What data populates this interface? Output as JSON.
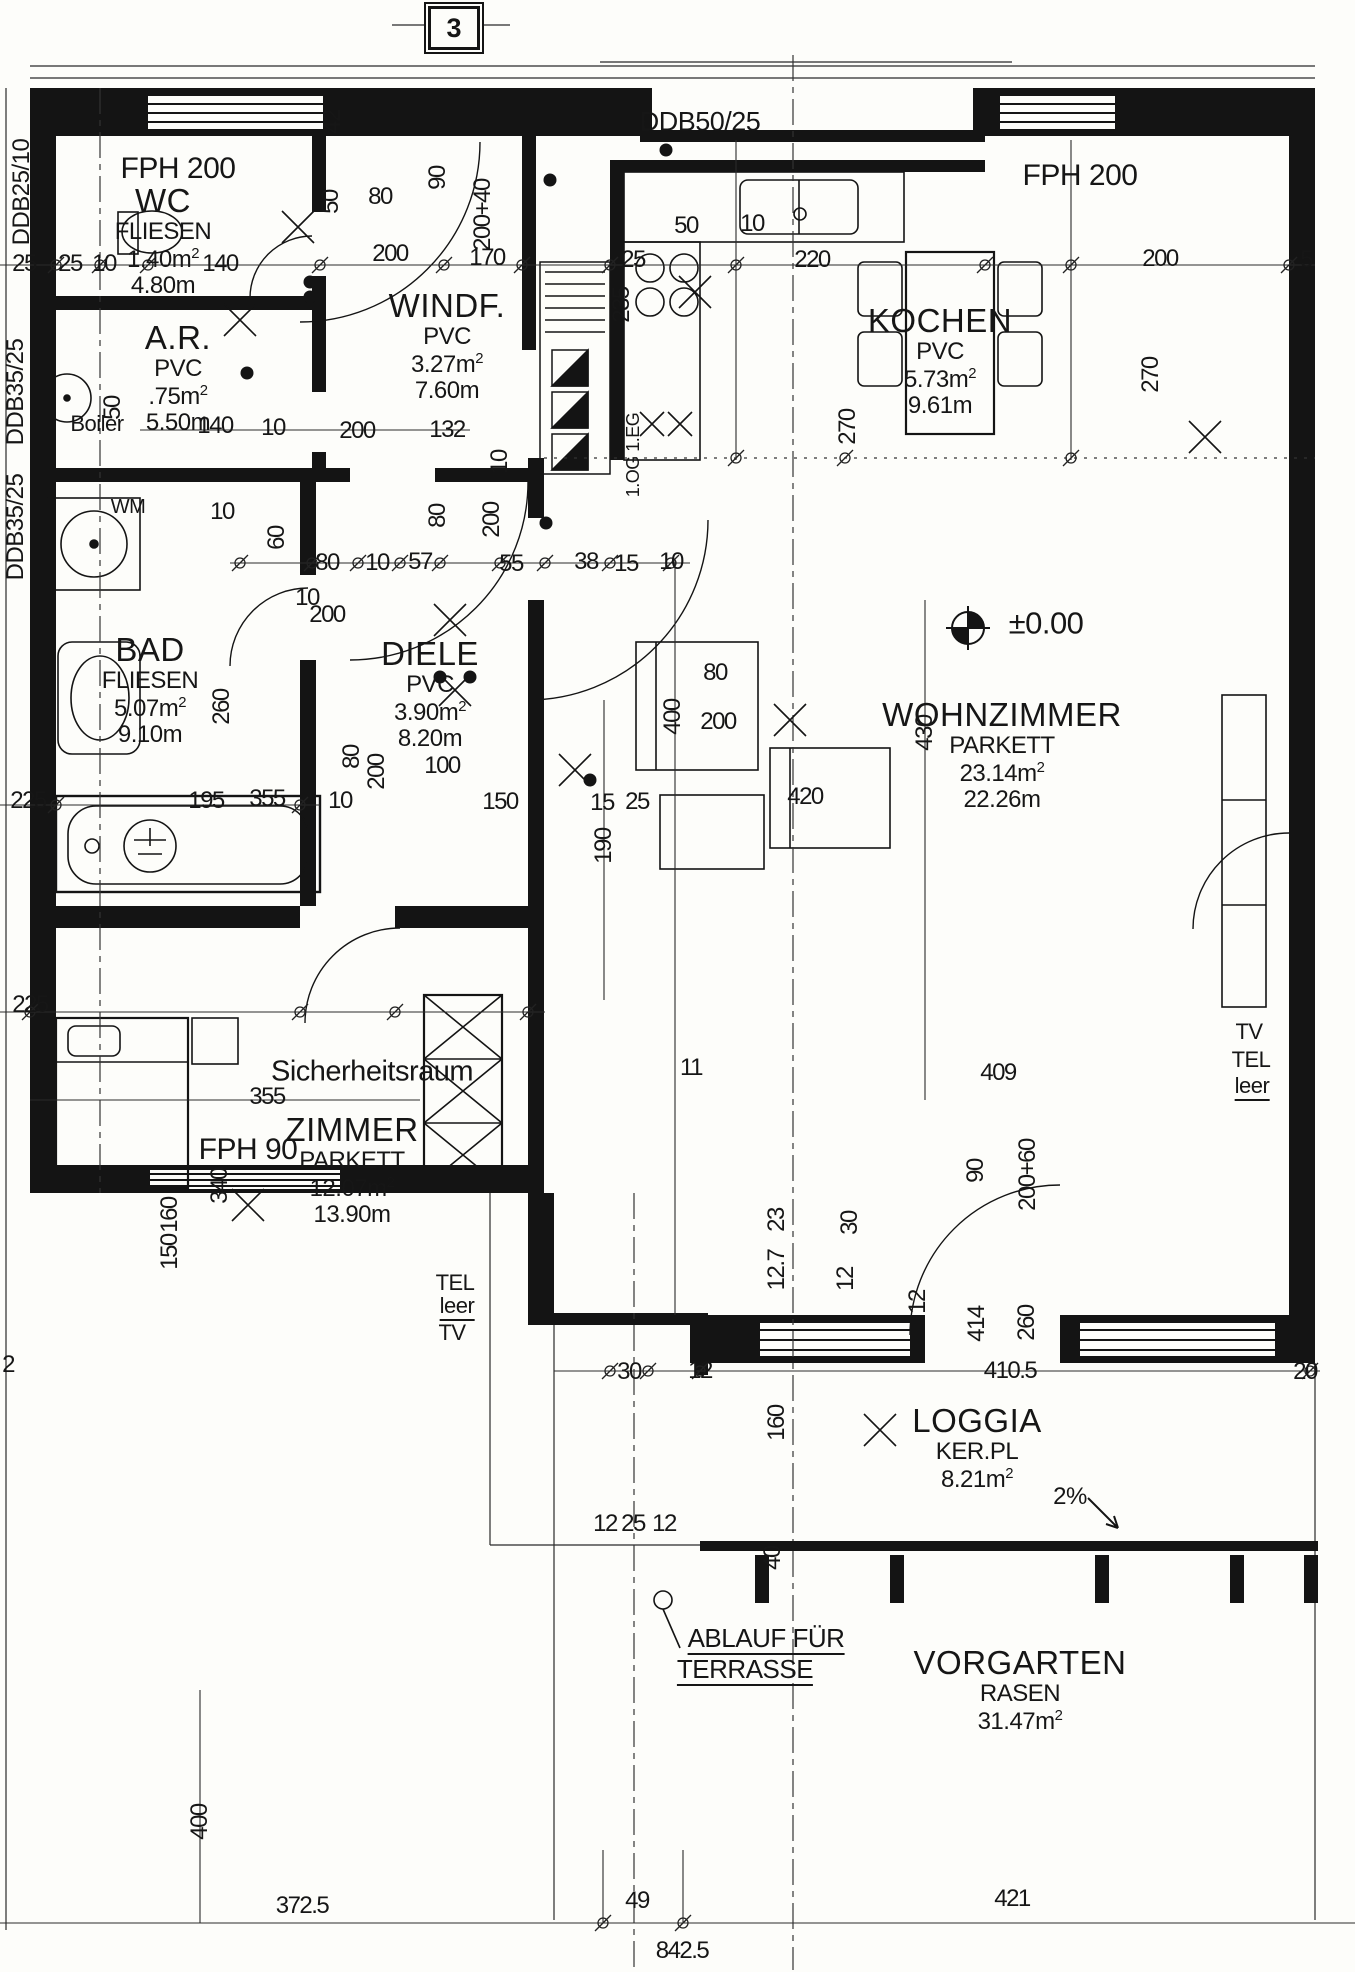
{
  "title": "Grundriss Wohnung EG (floor plan)",
  "sheet_number": "3",
  "colors": {
    "ink": "#161616",
    "paper": "#fdfdfa"
  },
  "rooms": [
    {
      "name": "WC",
      "floor": "FLIESEN",
      "area": "1.40",
      "perim": "4.80",
      "x": 163,
      "y": 183
    },
    {
      "name": "WINDF.",
      "floor": "PVC",
      "area": "3.27",
      "perim": "7.60",
      "x": 447,
      "y": 288
    },
    {
      "name": "A.R.",
      "floor": "PVC",
      "area": ".75",
      "perim": "5.50",
      "x": 178,
      "y": 320
    },
    {
      "name": "KOCHEN",
      "floor": "PVC",
      "area": "5.73",
      "perim": "9.61",
      "x": 940,
      "y": 303
    },
    {
      "name": "BAD",
      "floor": "FLIESEN",
      "area": "5.07",
      "perim": "9.10",
      "x": 150,
      "y": 632
    },
    {
      "name": "DIELE",
      "floor": "PVC",
      "area": "3.90",
      "perim": "8.20",
      "x": 430,
      "y": 636
    },
    {
      "name": "WOHNZIMMER",
      "floor": "PARKETT",
      "area": "23.14",
      "perim": "22.26",
      "x": 1002,
      "y": 697
    },
    {
      "name": "ZIMMER",
      "floor": "PARKETT",
      "area": "12.07",
      "perim": "13.90",
      "x": 352,
      "y": 1112
    },
    {
      "name": "LOGGIA",
      "floor": "KER.PL",
      "area": "8.21",
      "perim": "",
      "x": 977,
      "y": 1403
    },
    {
      "name": "VORGARTEN",
      "floor": "RASEN",
      "area": "31.47",
      "perim": "",
      "x": 1020,
      "y": 1645
    }
  ],
  "annotations": [
    {
      "id": "fph-200-left",
      "t": "FPH 200",
      "x": 178,
      "y": 169,
      "fs": 30
    },
    {
      "id": "ddb50-25",
      "t": "DDB50/25",
      "x": 700,
      "y": 122,
      "fs": 27
    },
    {
      "id": "fph-200-right",
      "t": "FPH 200",
      "x": 1080,
      "y": 176,
      "fs": 30
    },
    {
      "id": "fph-90",
      "t": "FPH 90",
      "x": 248,
      "y": 1150,
      "fs": 30
    },
    {
      "id": "ddb25-10",
      "t": "DDB25/10",
      "x": 22,
      "y": 192,
      "r": 1,
      "fs": 24
    },
    {
      "id": "ddb35-25-a",
      "t": "DDB35/25",
      "x": 16,
      "y": 392,
      "r": 1,
      "fs": 24
    },
    {
      "id": "ddb35-25-b",
      "t": "DDB35/25",
      "x": 16,
      "y": 527,
      "r": 1,
      "fs": 24
    },
    {
      "id": "wm",
      "t": "WM",
      "x": 128,
      "y": 507,
      "fs": 20
    },
    {
      "id": "boiler",
      "t": "Boiler",
      "x": 97,
      "y": 424,
      "fs": 22
    },
    {
      "id": "level",
      "t": "±0.00",
      "x": 1046,
      "y": 623,
      "fs": 31
    },
    {
      "id": "sicherheitsraum",
      "t": "Sicherheitsraum",
      "x": 372,
      "y": 1072,
      "fs": 29
    },
    {
      "id": "tv-right",
      "t": "TV",
      "x": 1249,
      "y": 1032,
      "fs": 22
    },
    {
      "id": "tel-right",
      "t": "TEL",
      "x": 1251,
      "y": 1060,
      "fs": 22
    },
    {
      "id": "leer-right",
      "t": "leer",
      "x": 1252,
      "y": 1088,
      "fs": 22,
      "u": 1
    },
    {
      "id": "tel-left",
      "t": "TEL",
      "x": 455,
      "y": 1283,
      "fs": 22
    },
    {
      "id": "leer-left",
      "t": "leer",
      "x": 457,
      "y": 1308,
      "fs": 22,
      "u": 1
    },
    {
      "id": "tv-left",
      "t": "TV",
      "x": 452,
      "y": 1333,
      "fs": 22
    },
    {
      "id": "ablauf",
      "t": "ABLAUF FÜR",
      "x": 766,
      "y": 1640,
      "fs": 26,
      "u": 1
    },
    {
      "id": "terrasse",
      "t": "TERRASSE",
      "x": 745,
      "y": 1671,
      "fs": 26,
      "u": 1
    },
    {
      "id": "slope",
      "t": "2%",
      "x": 1070,
      "y": 1497,
      "fs": 24
    },
    {
      "id": "og-eg",
      "t": "1.OG 1.EG",
      "x": 633,
      "y": 455,
      "r": 1,
      "fs": 18
    }
  ],
  "dimensions": [
    {
      "t": "25",
      "x": 24,
      "y": 264
    },
    {
      "t": "25",
      "x": 70,
      "y": 264
    },
    {
      "t": "10",
      "x": 104,
      "y": 264
    },
    {
      "t": "140",
      "x": 220,
      "y": 264
    },
    {
      "t": "200",
      "x": 390,
      "y": 254
    },
    {
      "t": "170",
      "x": 487,
      "y": 258
    },
    {
      "t": "25",
      "x": 633,
      "y": 260
    },
    {
      "t": "50",
      "x": 686,
      "y": 226
    },
    {
      "t": "10",
      "x": 752,
      "y": 224
    },
    {
      "t": "220",
      "x": 812,
      "y": 260
    },
    {
      "t": "200",
      "x": 1160,
      "y": 259
    },
    {
      "t": "5",
      "x": 1306,
      "y": 260
    },
    {
      "t": "42",
      "x": 333,
      "y": 122,
      "r": 1
    },
    {
      "t": "50",
      "x": 331,
      "y": 202,
      "r": 1
    },
    {
      "t": "80",
      "x": 380,
      "y": 197
    },
    {
      "t": "90",
      "x": 438,
      "y": 178,
      "r": 1
    },
    {
      "t": "200+40",
      "x": 483,
      "y": 215,
      "r": 1
    },
    {
      "t": "140",
      "x": 215,
      "y": 426
    },
    {
      "t": "10",
      "x": 273,
      "y": 428
    },
    {
      "t": "200",
      "x": 357,
      "y": 431
    },
    {
      "t": "132",
      "x": 447,
      "y": 430
    },
    {
      "t": "50",
      "x": 113,
      "y": 408,
      "r": 1
    },
    {
      "t": "235",
      "x": 622,
      "y": 305,
      "r": 1
    },
    {
      "t": "270",
      "x": 848,
      "y": 427,
      "r": 1
    },
    {
      "t": "270",
      "x": 1151,
      "y": 375,
      "r": 1
    },
    {
      "t": "10",
      "x": 500,
      "y": 462,
      "r": 1
    },
    {
      "t": "200",
      "x": 492,
      "y": 520,
      "r": 1
    },
    {
      "t": "80",
      "x": 438,
      "y": 516,
      "r": 1
    },
    {
      "t": "80",
      "x": 327,
      "y": 563
    },
    {
      "t": "10",
      "x": 377,
      "y": 563
    },
    {
      "t": "57",
      "x": 420,
      "y": 562
    },
    {
      "t": "55",
      "x": 511,
      "y": 564
    },
    {
      "t": "38",
      "x": 586,
      "y": 562
    },
    {
      "t": "15",
      "x": 626,
      "y": 564
    },
    {
      "t": "10",
      "x": 671,
      "y": 562
    },
    {
      "t": "200",
      "x": 327,
      "y": 615
    },
    {
      "t": "60",
      "x": 277,
      "y": 538,
      "r": 1
    },
    {
      "t": "10",
      "x": 222,
      "y": 512
    },
    {
      "t": "10",
      "x": 307,
      "y": 598
    },
    {
      "t": "260",
      "x": 222,
      "y": 707,
      "r": 1
    },
    {
      "t": "225",
      "x": 28,
      "y": 801
    },
    {
      "t": "195",
      "x": 206,
      "y": 801
    },
    {
      "t": "10",
      "x": 340,
      "y": 801
    },
    {
      "t": "150",
      "x": 500,
      "y": 802
    },
    {
      "t": "15",
      "x": 602,
      "y": 803
    },
    {
      "t": "25",
      "x": 637,
      "y": 802
    },
    {
      "t": "80",
      "x": 352,
      "y": 757,
      "r": 1
    },
    {
      "t": "200",
      "x": 377,
      "y": 772,
      "r": 1
    },
    {
      "t": "100",
      "x": 442,
      "y": 766
    },
    {
      "t": "80",
      "x": 715,
      "y": 673
    },
    {
      "t": "200",
      "x": 718,
      "y": 722
    },
    {
      "t": "400",
      "x": 673,
      "y": 717,
      "r": 1
    },
    {
      "t": "430",
      "x": 925,
      "y": 733,
      "r": 1
    },
    {
      "t": "420",
      "x": 805,
      "y": 797
    },
    {
      "t": "190",
      "x": 604,
      "y": 846,
      "r": 1
    },
    {
      "t": "409",
      "x": 998,
      "y": 1073
    },
    {
      "t": "11",
      "x": 691,
      "y": 1068
    },
    {
      "t": "90",
      "x": 976,
      "y": 1171,
      "r": 1
    },
    {
      "t": "200+60",
      "x": 1028,
      "y": 1175,
      "r": 1
    },
    {
      "t": "23",
      "x": 777,
      "y": 1220,
      "r": 1
    },
    {
      "t": "30",
      "x": 850,
      "y": 1223,
      "r": 1
    },
    {
      "t": "12.7",
      "x": 777,
      "y": 1270,
      "r": 1
    },
    {
      "t": "12",
      "x": 846,
      "y": 1279,
      "r": 1
    },
    {
      "t": "340",
      "x": 220,
      "y": 1186,
      "r": 1
    },
    {
      "t": "355",
      "x": 267,
      "y": 799
    },
    {
      "t": "355",
      "x": 267,
      "y": 1097
    },
    {
      "t": "225",
      "x": 30,
      "y": 1005
    },
    {
      "t": "2",
      "x": 8,
      "y": 1365
    },
    {
      "t": "160",
      "x": 170,
      "y": 1215,
      "r": 1
    },
    {
      "t": "150",
      "x": 170,
      "y": 1252,
      "r": 1
    },
    {
      "t": "30",
      "x": 629,
      "y": 1372
    },
    {
      "t": "12",
      "x": 700,
      "y": 1371
    },
    {
      "t": "410.5",
      "x": 1010,
      "y": 1371
    },
    {
      "t": "20",
      "x": 1305,
      "y": 1372
    },
    {
      "t": "12",
      "x": 918,
      "y": 1302,
      "r": 1
    },
    {
      "t": "414",
      "x": 977,
      "y": 1324,
      "r": 1
    },
    {
      "t": "260",
      "x": 1027,
      "y": 1323,
      "r": 1
    },
    {
      "t": "160",
      "x": 777,
      "y": 1423,
      "r": 1
    },
    {
      "t": "40",
      "x": 773,
      "y": 1558,
      "r": 1
    },
    {
      "t": "12",
      "x": 605,
      "y": 1524
    },
    {
      "t": "25",
      "x": 633,
      "y": 1524
    },
    {
      "t": "12",
      "x": 664,
      "y": 1524
    },
    {
      "t": "400",
      "x": 200,
      "y": 1822,
      "r": 1
    },
    {
      "t": "372.5",
      "x": 302,
      "y": 1906
    },
    {
      "t": "49",
      "x": 637,
      "y": 1901
    },
    {
      "t": "421",
      "x": 1012,
      "y": 1899
    },
    {
      "t": "842.5",
      "x": 682,
      "y": 1951
    }
  ]
}
